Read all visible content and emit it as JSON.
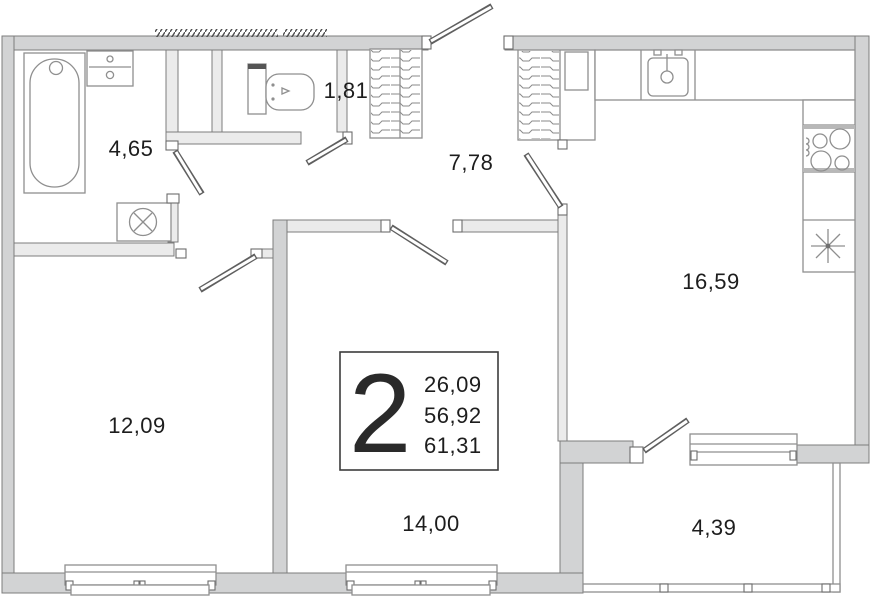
{
  "title": "2-room apartment floor plan",
  "colors": {
    "background": "#ffffff",
    "wall_fill": "#d2d3d4",
    "wall_int_fill": "#ebebeb",
    "wall_stroke": "#7c7c7c",
    "fixture_stroke": "#8f8f8f",
    "text": "#1d1d1d"
  },
  "info_box": {
    "room_count": "2",
    "living_area": "26,09",
    "area": "56,92",
    "total_area": "61,31"
  },
  "rooms": {
    "bathroom": {
      "area": "4,65"
    },
    "wc": {
      "area": "1,81"
    },
    "hallway": {
      "area": "7,78"
    },
    "kitchen": {
      "area": "16,59"
    },
    "bedroom": {
      "area": "12,09"
    },
    "living_room": {
      "area": "14,00"
    },
    "balcony": {
      "area": "4,39"
    }
  },
  "icons": {
    "bathtub": "bathtub-symbol",
    "vanity": "vanity-sink-symbol",
    "washing_machine": "circle-x-symbol",
    "toilet": "toilet-symbol",
    "kitchen_sink": "sink-faucet-symbol",
    "stove": "four-burner-symbol",
    "fridge": "asterisk-star-symbol",
    "wardrobe": "hatched-shelf-symbol"
  }
}
